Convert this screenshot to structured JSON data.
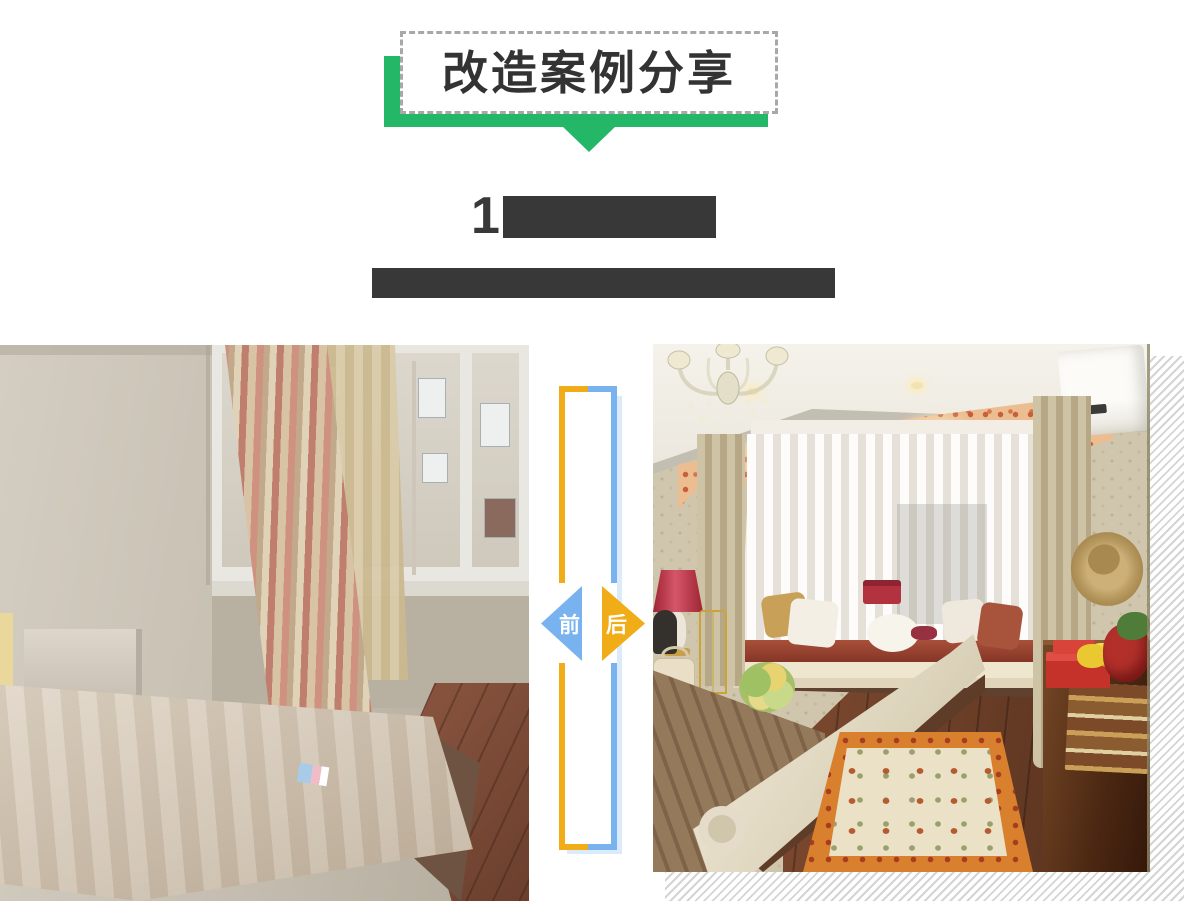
{
  "banner": {
    "title": "改造案例分享"
  },
  "heading": {
    "title_visible_text": "1",
    "title_redacted": true,
    "subtitle_redacted": true
  },
  "comparison": {
    "before_label": "前",
    "after_label": "后",
    "before_photo": "old-bedroom-bare-mattress-window",
    "after_photo": "renovated-bedroom-bay-window-chandelier"
  },
  "colors": {
    "accent_green": "#25b768",
    "before_blue": "#79b3ef",
    "after_yellow": "#f0ad18",
    "redaction_dark": "#383838",
    "dashed_border_gray": "#a8a8a8",
    "shadow_stripe_gray": "#d4d4d4"
  }
}
